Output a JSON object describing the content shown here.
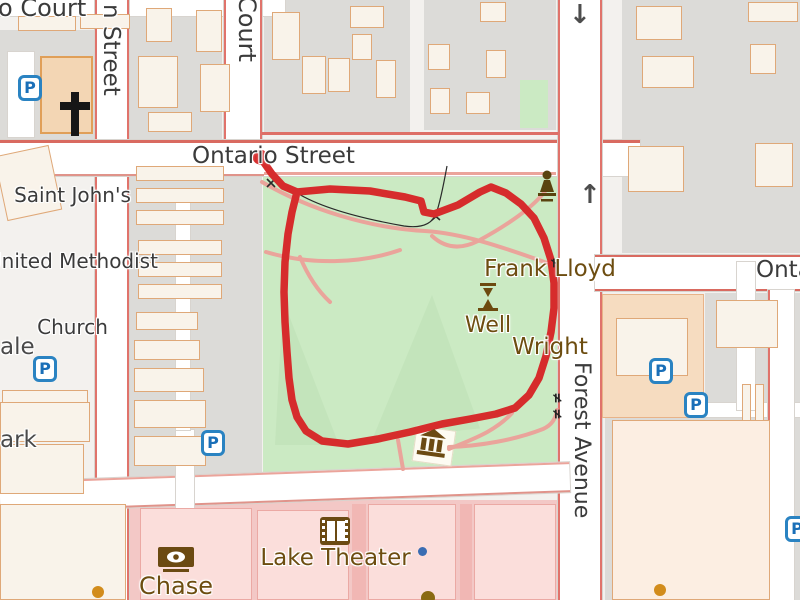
{
  "streets": {
    "court_top_fragment": "o Court",
    "left_street_fragment": "n Street",
    "court_vertical": "Court",
    "ontario_street": "Ontario Street",
    "ontario_east": "Ontario",
    "forest_avenue": "Forest Avenue"
  },
  "places": {
    "church_lines": [
      "Saint John's",
      "United Methodist",
      "Church"
    ],
    "park_fragments": [
      "ale",
      "ark"
    ],
    "flw_lines": [
      "Frank Lloyd",
      "Wright"
    ],
    "well": "Well",
    "theater": "Lake Theater",
    "bank": "Chase"
  },
  "icons": {
    "parking": "P",
    "oneway_down": "↓",
    "oneway_up": "↑",
    "picnic": "≠"
  },
  "colors": {
    "route": "#d62c2c",
    "park_green": "#cbeac3",
    "block_gray": "#dcdbd8",
    "building_cream": "#f9f3ea",
    "building_stroke": "#dfa878",
    "retail_pink": "#f3c8c6",
    "path_pink": "#eaa49b",
    "poi_label": "#6d4d10",
    "parking_blue": "#2a83c2"
  },
  "route": {
    "start_cx": "260",
    "start_cy": "157",
    "d": "M260,157 L272,174 L283,186 L297,192 L330,189 L370,191 L405,197 L421,201 L424,212 L434,214 L458,205 L480,192 L491,187 L506,193 L521,204 L534,218 L544,238 L551,260 L554,283 L554,308 L551,332 L546,356 L539,378 L529,395 L515,408 L496,414 L470,419 L442,424 L410,432 L378,439 L348,444 L322,441 L306,431 L297,417 L292,400 L289,378 L287,352 L285,322 L284,292 L285,262 L288,234 L292,212 L297,192"
  },
  "overlay": {
    "black_path": "M447,166 C443,188 440,203 436,214 C431,226 418,228 404,226 C370,220 325,210 297,193",
    "crosses": "M432,213 l8,7 M440,213 l-8,7 M267,179 l8,8 M275,179 l-8,8",
    "pink_paths": [
      "M262,182 C310,210 370,228 425,231 C470,234 515,252 556,266",
      "M546,190 C534,207 506,226 478,241 C460,250 445,248 432,236",
      "M266,252 C310,265 360,264 400,250",
      "M300,257 C308,276 318,291 330,302",
      "M449,447 C480,446 515,440 543,429 C552,425 556,418 557,410",
      "M449,449 C470,440 495,432 512,413",
      "M398,440 L403,469"
    ]
  }
}
